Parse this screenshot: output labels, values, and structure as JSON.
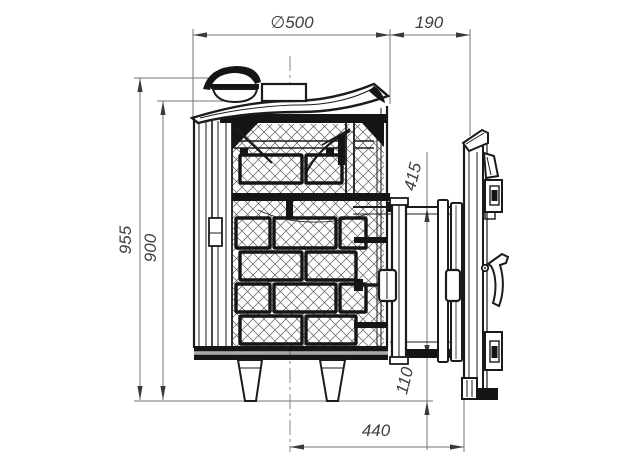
{
  "drawing": {
    "type": "technical-drawing-side-section",
    "background_color": "#ffffff",
    "object_line_color": "#1b1b1b",
    "dimension_line_color": "#757575",
    "dimension_text_color": "#3f3f3f",
    "dimensions": {
      "top_diameter": "∅500",
      "tunnel_extension": "190",
      "overall_height": "955",
      "body_height": "900",
      "firebox_opening_height": "415",
      "bottom_clearance": "110",
      "axis_to_door_front": "440"
    }
  }
}
